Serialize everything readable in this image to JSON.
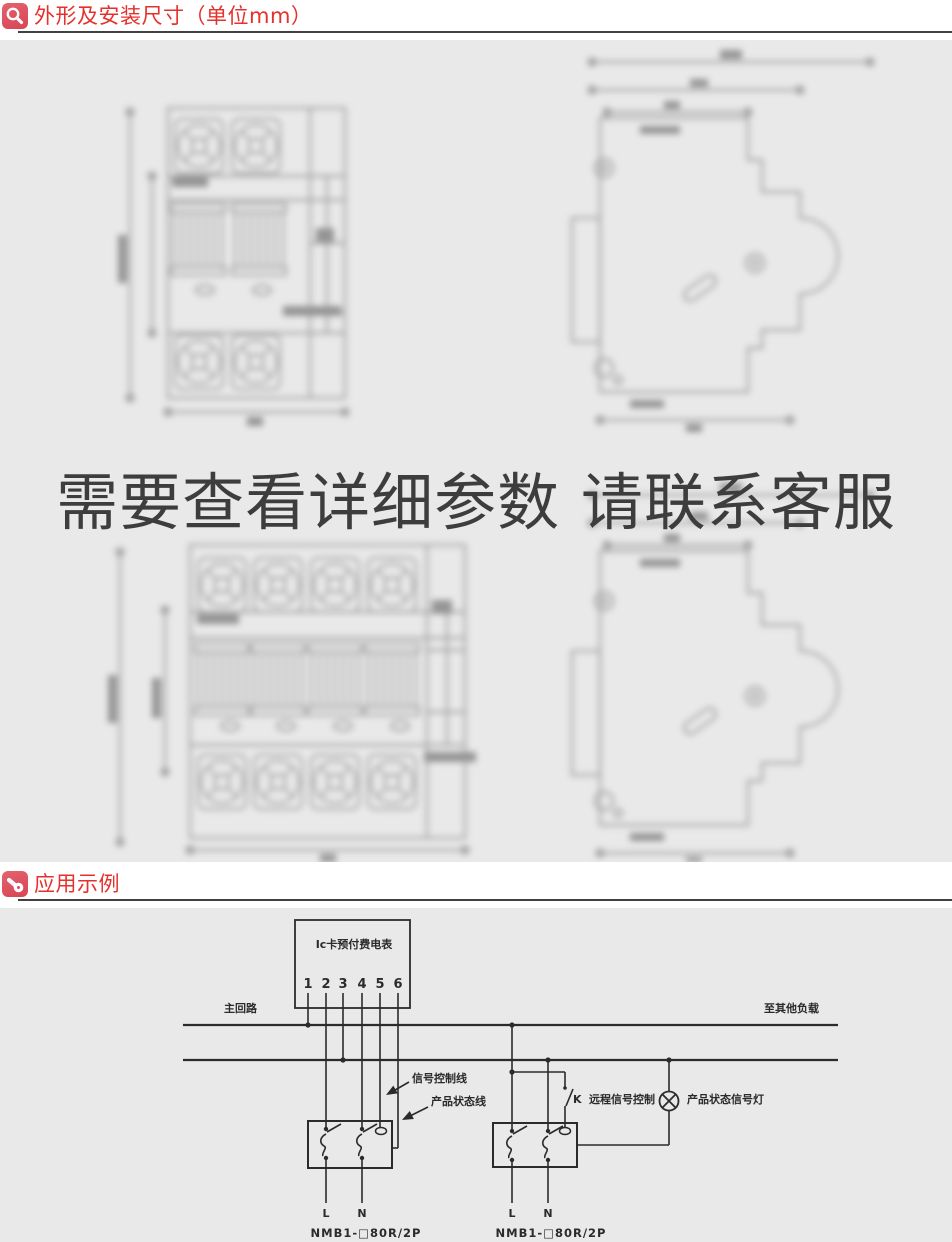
{
  "page": {
    "bg": "#e9e9e9",
    "accent_red": "#e6302c",
    "icon_red": "#db4e5e",
    "rule_color": "#414141",
    "ink": "#2b2b2b",
    "overlay_ink": "#3d3d3d"
  },
  "section_dimensions": {
    "title": "外形及安装尺寸（单位mm）",
    "icon": "magnifier-icon",
    "overlay_notice": "需要查看详细参数 请联系客服"
  },
  "section_application": {
    "title": "应用示例",
    "icon": "stamp-icon"
  },
  "wiring": {
    "meter_label": "Ic卡预付费电表",
    "terminals": [
      "1",
      "2",
      "3",
      "4",
      "5",
      "6"
    ],
    "main_circuit": "主回路",
    "to_other_loads": "至其他负载",
    "signal_control_line": "信号控制线",
    "product_status_line": "产品状态线",
    "switch_k": "K",
    "remote_signal_control": "远程信号控制",
    "status_lamp": "产品状态信号灯",
    "left_breaker": {
      "l": "L",
      "n": "N",
      "model": "NMB1-□80R/2P"
    },
    "right_breaker": {
      "l": "L",
      "n": "N",
      "model": "NMB1-□80R/2P"
    }
  }
}
